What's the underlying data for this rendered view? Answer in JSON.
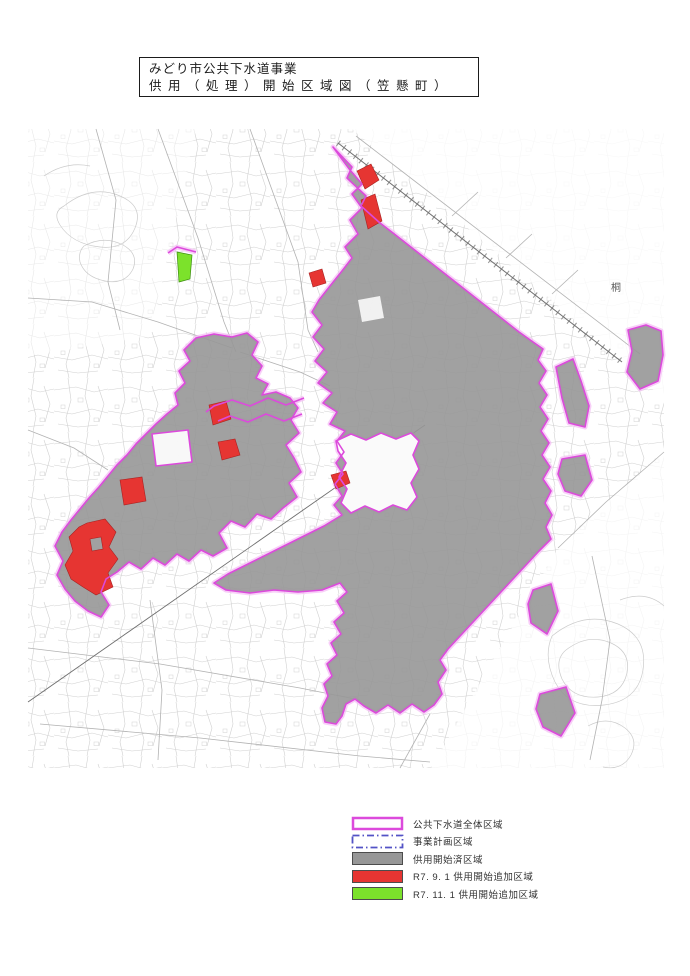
{
  "title_block": {
    "line1": "みどり市公共下水道事業",
    "line2": "供用（処理）開始区域図（笠懸町）"
  },
  "map": {
    "label_east": "桐"
  },
  "legend": {
    "items": [
      {
        "label": "公共下水道全体区域"
      },
      {
        "label": "事業計画区域"
      },
      {
        "label": "供用開始済区域"
      },
      {
        "label": "R7. 9. 1 供用開始追加区域"
      },
      {
        "label": "R7. 11. 1 供用開始追加区域"
      }
    ]
  },
  "colors": {
    "boundary_magenta": "#DC4ADC",
    "boundary_halo": "#F5BBF5",
    "plan_dashdot": "#5353C6",
    "served_gray": "#979797",
    "added_red": "#E63532",
    "added_green": "#7CE22B",
    "swatch_border": "#4C4C4C",
    "red_edge": "#A82222",
    "green_edge": "#3E8E12",
    "base_gray": "#CBCBCB",
    "road_gray": "#B2B2B2",
    "rail_gray": "#6E6E6E",
    "label_gray": "#5A5A5A"
  }
}
